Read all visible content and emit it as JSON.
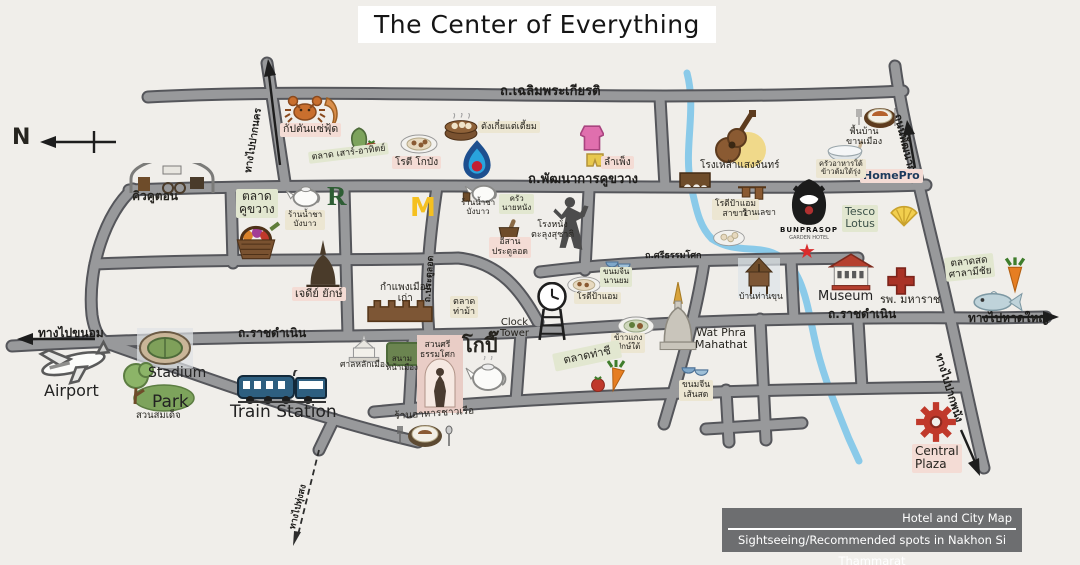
{
  "title": "The Center of Everything",
  "compass": {
    "n": "N"
  },
  "legend": {
    "line1": "Hotel and City Map",
    "line2": "Sightseeing/Recommended spots in Nakhon Si Thammarat"
  },
  "colors": {
    "background": "#f0eeea",
    "road_fill": "#98999b",
    "road_edge": "#55565b",
    "river": "#8acae9",
    "box_cream": "#ece6d2",
    "box_pink": "#f4dcd5",
    "box_green": "#e2e7d0",
    "legend_bg": "#6d6e70",
    "star_red": "#d92b2b"
  },
  "roads": {
    "chaloem": "ถ.เฉลิมพระเกียรติ",
    "phatthanakan_khukwang": "ถ.พัฒนาการคูขวาง",
    "ratchadamnoen_left": "ถ.ราชดำเนิน",
    "ratchadamnoen_right": "ถ.ราชดำเนิน",
    "si_thammasok": "ถ.ศรีธรรมโศก",
    "pratulod": "ถ.ประตูลอด",
    "phatthanakan_vertical": "ถนนพัฒนาการ",
    "to_pak_nakhon": "ทางไปปากนคร",
    "to_khanom": "ทางไปขนอม",
    "to_hat_yai": "ทางไปหาดใหญ่",
    "to_pak_phanang": "ทางไปปากพนัง",
    "to_thung_song": "ทางไปทุ่งสง"
  },
  "places": {
    "airport": "Airport",
    "stadium": "Stadium",
    "park": "Park",
    "park_thai": "สวนสมเด็จ",
    "train_station": "Train Station",
    "kiw_khu_ton": "คิวคูตอน",
    "captain_seafood": "กัปตันแซ่ฟุ้ด",
    "weekend_market": "ตลาด เสาร์-อาทิตย์",
    "roti_kobang": "โรตี โกบัง",
    "tang_kia": "ตังเกี๋ยแต่เตี้ยม",
    "lam_pheng": "ลำเพ็ง",
    "saengchan_bar": "โรงเหล้าแสงจันทร์",
    "roti_pa_aem_branch": "โรตีป้าแอม\nสาขา1",
    "ran_lekha": "ร้านเลขา",
    "bunprasop": "BUNPRASOP",
    "bunprasop_sub": "GARDEN HOTEL",
    "tesco": "Tesco\nLotus",
    "homepro": "HomePro",
    "krua_tai": "ครัวอาหารใต้\nข้าวต้มใต้รุ่ง",
    "phuenban": "พื้นบ้าน\nขานเมือง",
    "khu_khwang_market": "ตลาด\nคูขวาง",
    "tea_bangbao_1": "ร้านน้ำชา\nบังบาว",
    "tea_bangbao_2": "ร้านน้ำชา\nบังบาว",
    "r_letter": "R",
    "m_letter": "M",
    "krua_nai_nang": "ครัว\nนายหนัง",
    "isan_pratulod": "อีสาน\nประตูลอด",
    "nang_talung": "โรงหนัง\nตะลุงสุชาติ",
    "jedi_yak": "เจดีย์ ยักษ์",
    "old_wall": "กำแพงเมือง\nเก่า",
    "tha_ma_market": "ตลาด\nท่าม้า",
    "clock_tower": "Clock\nTower",
    "roti_pa_aem": "โรตีป้าแอม",
    "khanom_jin_nanyom": "ขนมจีน\nนานยม",
    "khao_kaeng": "ข้าวแกง\nปักษ์ใต้",
    "wat_phra": "Wat Phra\nMahathat",
    "baan_than_khun": "บ้านท่านขุน",
    "museum": "Museum",
    "maharaj_hospital": "รพ. มหาราช",
    "salamichai_market": "ตลาดสด\nศาลามีชัย",
    "tha_chi_market": "ตลาดท่าชี",
    "khanom_jin_sensod": "ขนมจีน\nเส้นสด",
    "chao_ruea": "ร้านอาหารชาวเรือ",
    "kopi": "โกปี๊",
    "suan_si_thammasok": "สวนศรี\nธรรมโศก",
    "sanam_na_mueang": "สนาม\nหน้าเมือง",
    "lak_mueang": "ศาลหลักเมือง",
    "central_plaza": "Central\nPlaza"
  },
  "icons": {
    "star_glyph": "★",
    "hotel_star": "red-star",
    "gas_station": "ptt-flame",
    "fast_food": "mcdonalds-m",
    "cafe": "r-coffee"
  }
}
